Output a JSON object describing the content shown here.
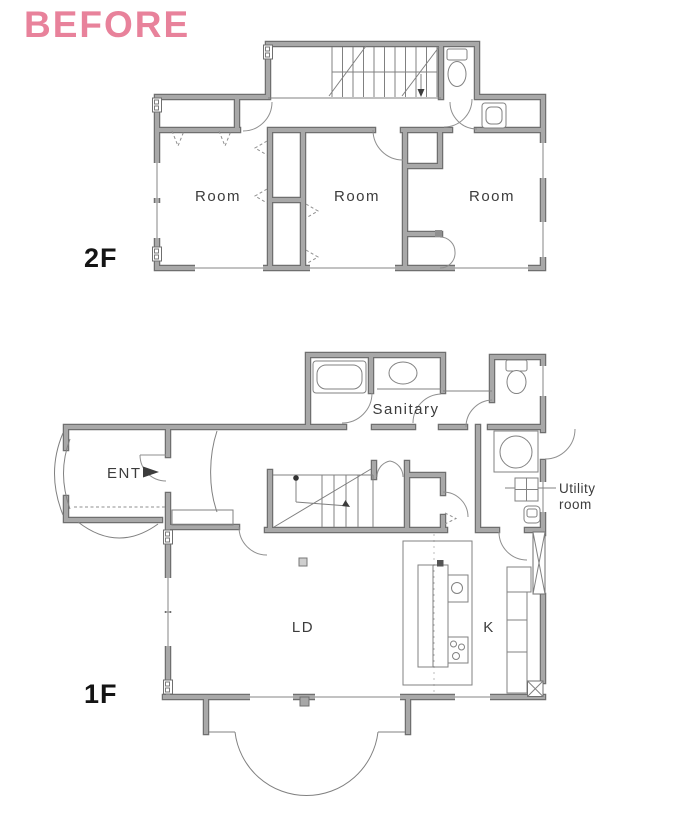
{
  "page": {
    "title": "BEFORE"
  },
  "colors": {
    "accent_pink": "#e8829b",
    "wall_gray": "#a8a8a8",
    "wall_edge_gray": "#6f6f6f",
    "line_gray": "#808080",
    "label_gray": "#3c3c3c",
    "floor_label_black": "#141414"
  },
  "floor2": {
    "label": "2F",
    "rooms": [
      "Room",
      "Room",
      "Room"
    ]
  },
  "floor1": {
    "label": "1F",
    "ent": "ENT",
    "sanitary": "Sanitary",
    "utility_line1": "Utility",
    "utility_line2": "room",
    "ld": "LD",
    "k": "K"
  }
}
